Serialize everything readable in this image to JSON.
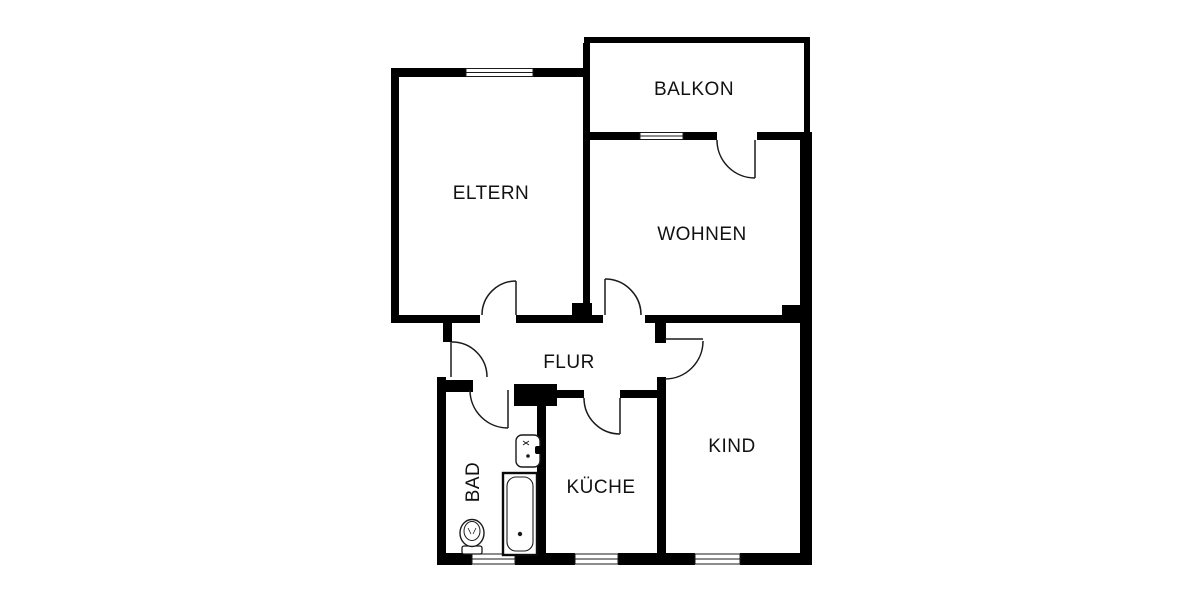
{
  "palette": {
    "background": "#ffffff",
    "wall": "#000000",
    "line": "#1a1a1a",
    "text": "#111111"
  },
  "rooms": [
    {
      "name": "eltern",
      "label": "ELTERN"
    },
    {
      "name": "balkon",
      "label": "BALKON"
    },
    {
      "name": "wohnen",
      "label": "WOHNEN"
    },
    {
      "name": "flur",
      "label": "FLUR"
    },
    {
      "name": "bad",
      "label": "BAD"
    },
    {
      "name": "kueche",
      "label": "KÜCHE"
    },
    {
      "name": "kind",
      "label": "KIND"
    }
  ],
  "fixtures": [
    {
      "name": "bathtub-icon"
    },
    {
      "name": "sink-icon"
    },
    {
      "name": "toilet-icon"
    }
  ],
  "symbols": {
    "window_count": 5,
    "door_count": 7
  }
}
